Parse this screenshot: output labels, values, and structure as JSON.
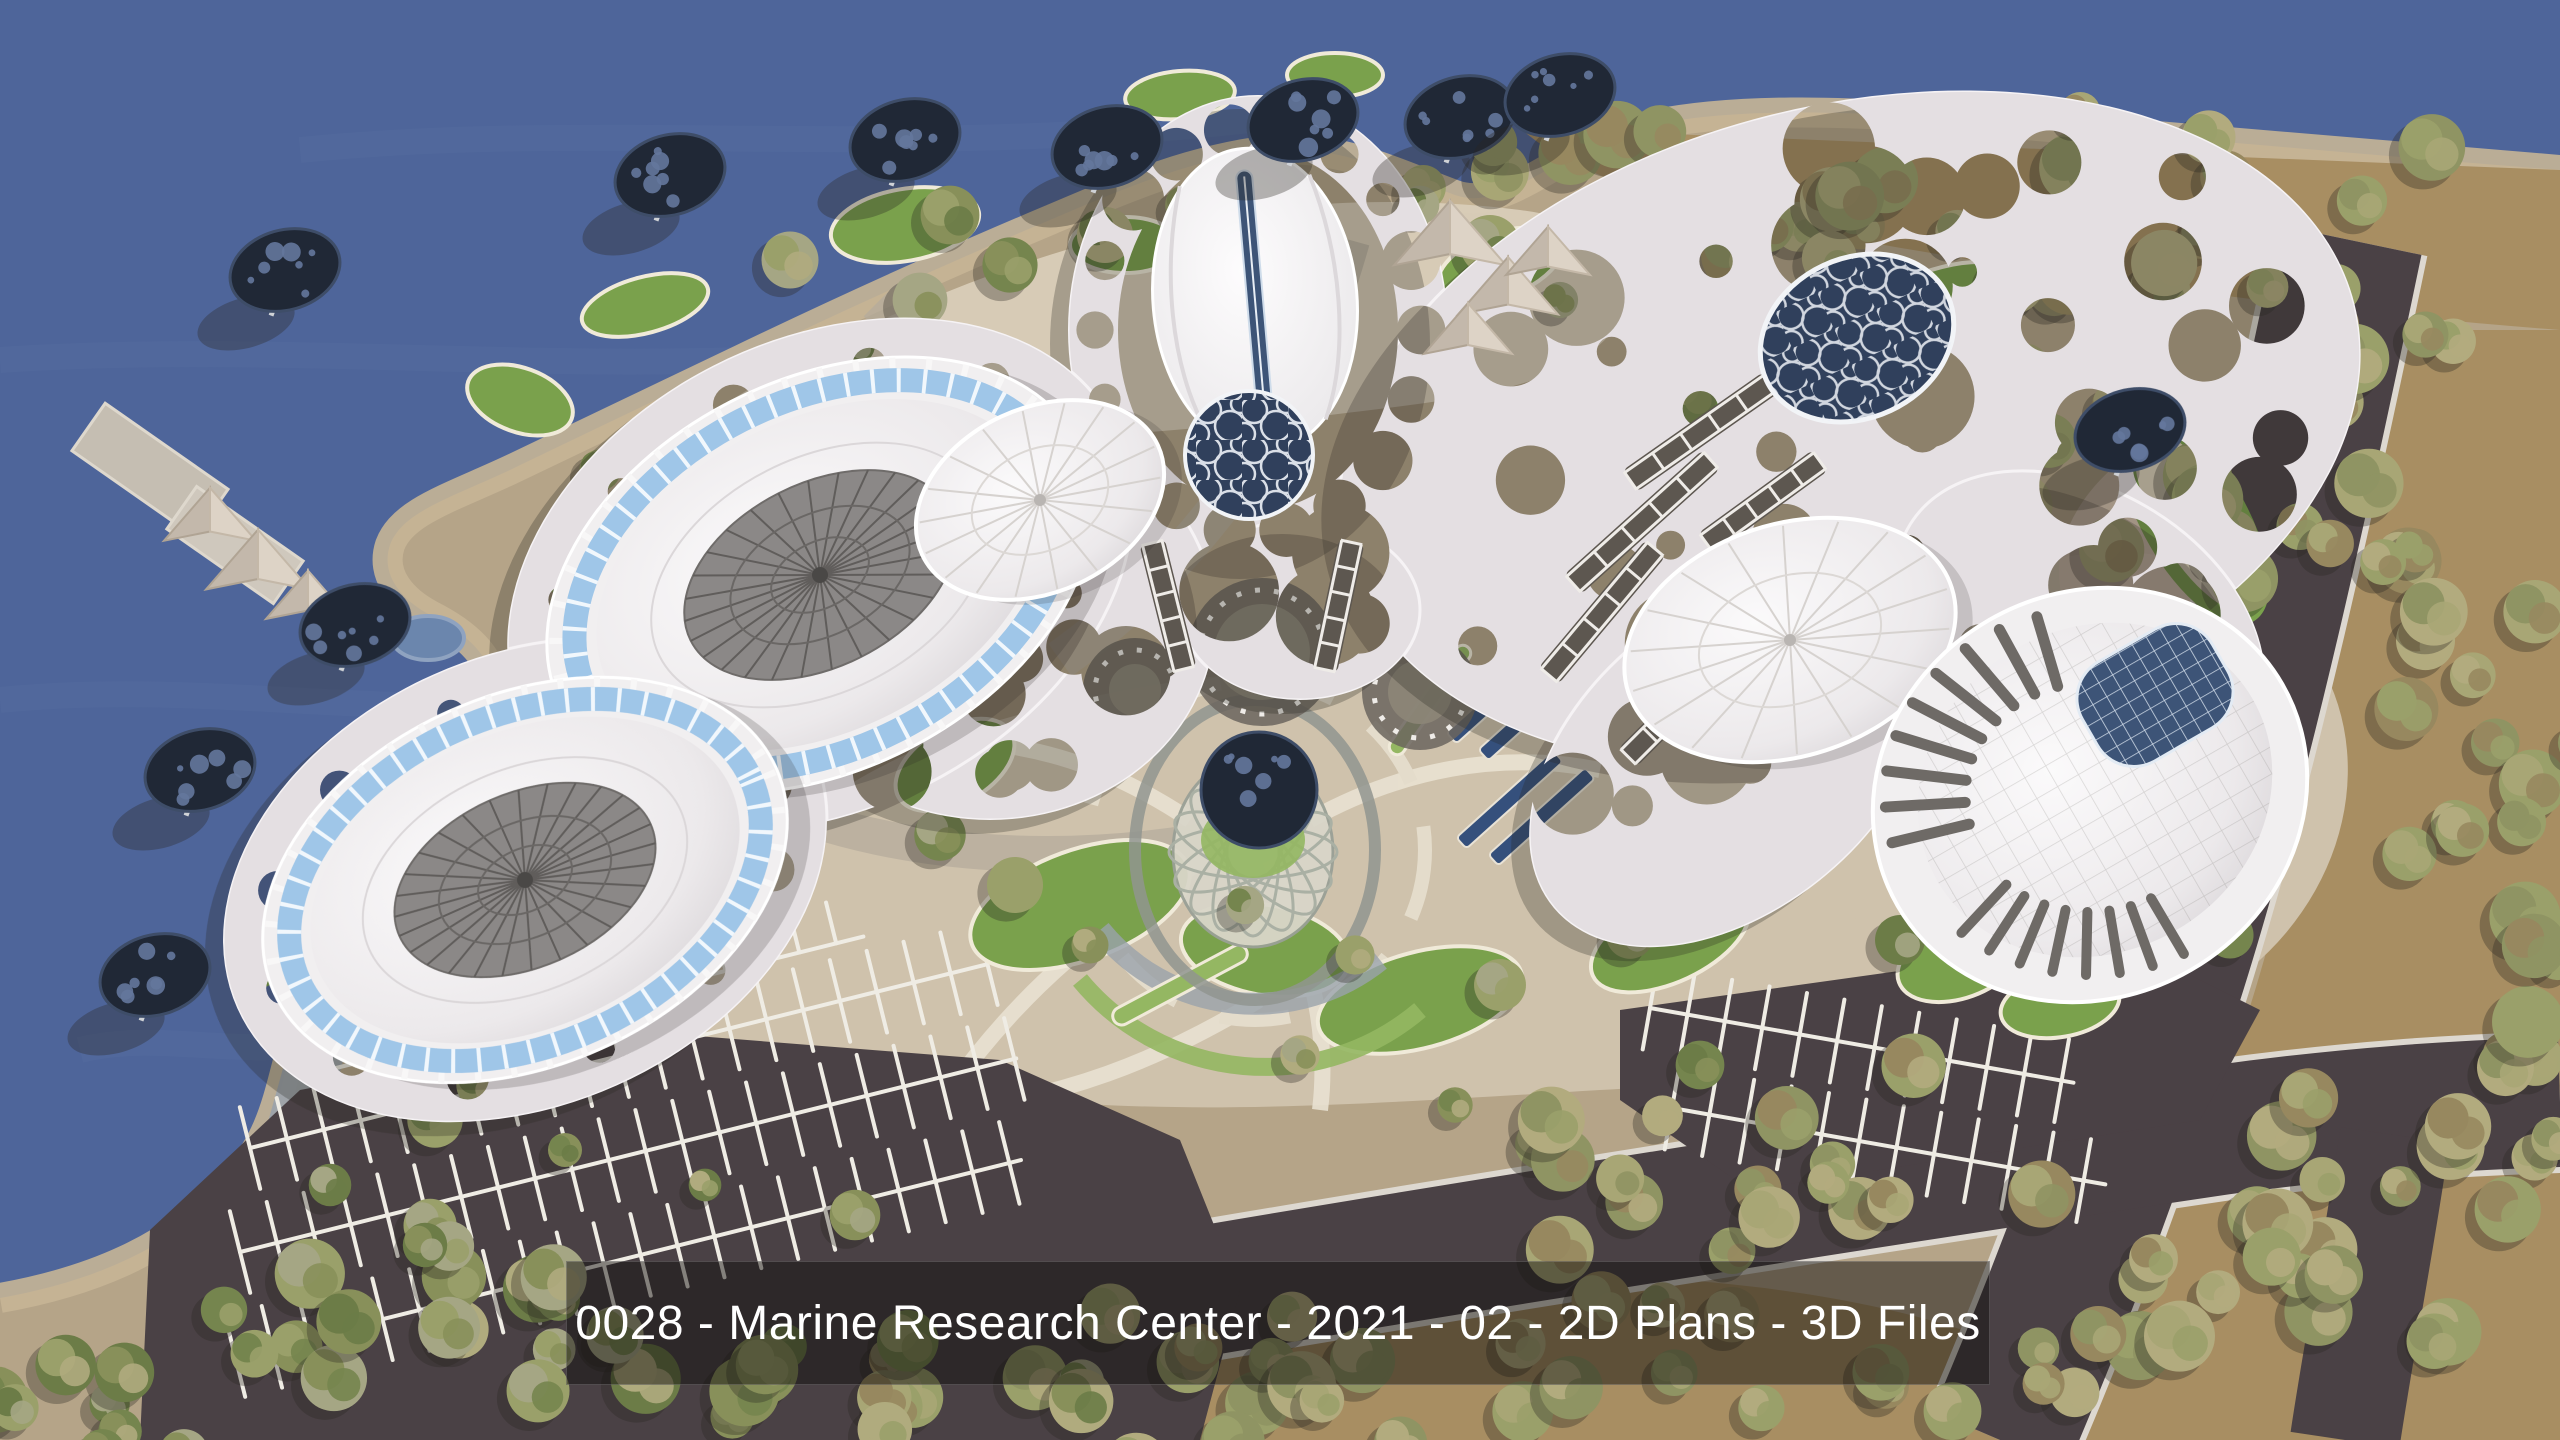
{
  "caption": {
    "text": "0028 - Marine Research Center - 2021 - 02 - 2D Plans - 3D Files"
  },
  "palette": {
    "water": "#4e659a",
    "water_light": "#5d74a9",
    "sand": "#b5a488",
    "beach": "#c6b596",
    "plaza": "#cfc2ac",
    "plazalight": "#d9cdb8",
    "forest": "#a88e62",
    "asphalt": "#4a4145",
    "lawn": "#7aa14c",
    "lawnlight": "#94b762",
    "canopy": "#e4dfe2",
    "shell": "#f1eff0",
    "glazing": "#9fc6e8",
    "roofgray": "#8b8887",
    "sky": "#3d5477",
    "louver": "#6e6a66",
    "disc": "#202836",
    "discdot": "#64779c",
    "stall": "#efece4",
    "cobble": "#9aa2ab",
    "web": "#edf1f6",
    "pool": "#35507c",
    "shadow": "rgba(42,38,34,0.33)",
    "caption_bg": "rgba(14,12,11,0.48)",
    "caption_text": "#ffffff",
    "tree_greens": [
      "#75854e",
      "#88905a",
      "#9aa06a",
      "#6c7c47",
      "#a5a684",
      "#b0ab7e"
    ],
    "tree_khaki": [
      "#9aa06a",
      "#a8a675",
      "#b2ab7e",
      "#8f9463",
      "#97885f"
    ]
  }
}
